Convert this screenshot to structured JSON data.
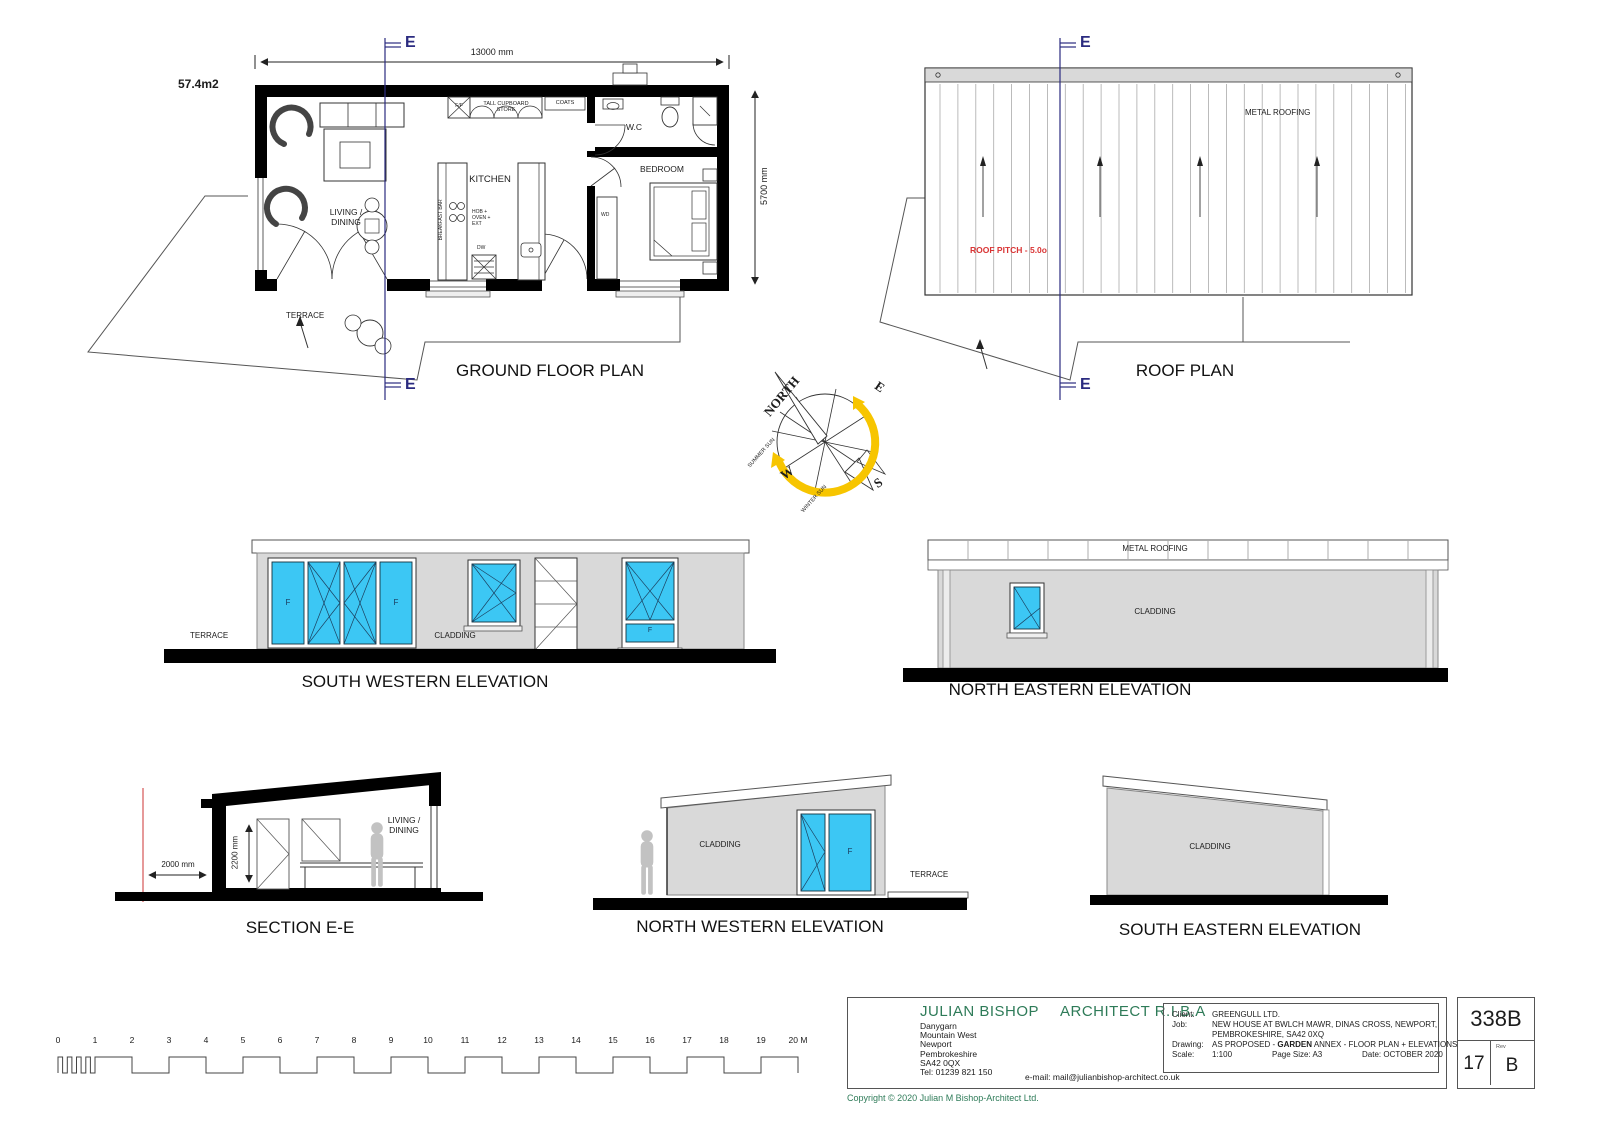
{
  "floor_plan": {
    "title": "GROUND FLOOR PLAN",
    "area": "57.4m2",
    "dim_width": "13000 mm",
    "dim_height": "5700 mm",
    "section_marker": "E",
    "living": "LIVING / DINING",
    "kitchen": "KITCHEN",
    "bedroom": "BEDROOM",
    "wc": "W.C",
    "terrace": "TERRACE",
    "coats": "COATS",
    "tall_cupboard": "TALL CUPBOARD STORE",
    "ff": "F/F",
    "breakfast_bar": "BREAKFAST BAR",
    "hob": "HOB + OVEN + EXT",
    "dw": "DW",
    "wd": "WD"
  },
  "roof_plan": {
    "title": "ROOF PLAN",
    "metal_roofing": "METAL ROOFING",
    "pitch": "ROOF PITCH - 5.0o",
    "section_marker": "E"
  },
  "compass": {
    "north": "NORTH",
    "east": "E",
    "west": "W",
    "south": "S",
    "summer_sun": "SUMMER SUN",
    "winter_sun": "WINTER SUN"
  },
  "elevation_sw": {
    "title": "SOUTH WESTERN ELEVATION",
    "terrace": "TERRACE",
    "cladding": "CLADDING",
    "f1": "F",
    "f2": "F",
    "f3": "F"
  },
  "elevation_ne": {
    "title": "NORTH EASTERN ELEVATION",
    "metal_roofing": "METAL ROOFING",
    "cladding": "CLADDING"
  },
  "section": {
    "title": "SECTION E-E",
    "room": "LIVING / DINING",
    "dim_offset": "2000 mm",
    "dim_height": "2200 mm"
  },
  "elevation_nw": {
    "title": "NORTH WESTERN ELEVATION",
    "cladding": "CLADDING",
    "terrace": "TERRACE",
    "f": "F"
  },
  "elevation_se": {
    "title": "SOUTH EASTERN ELEVATION",
    "cladding": "CLADDING"
  },
  "scale_bar": {
    "labels": [
      "0",
      "1",
      "2",
      "3",
      "4",
      "5",
      "6",
      "7",
      "8",
      "9",
      "10",
      "11",
      "12",
      "13",
      "14",
      "15",
      "16",
      "17",
      "18",
      "19",
      "20 M"
    ]
  },
  "title_block": {
    "architect_name": "JULIAN BISHOP",
    "architect_title": "ARCHITECT R.I.B.A",
    "address": [
      "Danygarn",
      "Mountain West",
      "Newport",
      "Pembrokeshire",
      "SA42 0QX",
      "Tel: 01239 821 150"
    ],
    "email": "e-mail: mail@julianbishop-architect.co.uk",
    "client_label": "Client:",
    "client": "GREENGULL LTD.",
    "job_label": "Job:",
    "job_line1": "NEW HOUSE AT BWLCH MAWR, DINAS CROSS, NEWPORT,",
    "job_line2": "PEMBROKESHIRE, SA42 0XQ",
    "drawing_label": "Drawing:",
    "drawing_pre": "AS PROPOSED - ",
    "drawing_bold": "GARDEN",
    "drawing_post": " ANNEX - FLOOR PLAN + ELEVATIONS",
    "scale_label": "Scale:",
    "scale_value": "1:100",
    "page_size": "Page Size: A3",
    "date": "Date: OCTOBER 2020",
    "number": "338B",
    "sheet": "17",
    "rev_label": "Rev",
    "rev": "B",
    "copyright": "Copyright © 2020 Julian M Bishop-Architect Ltd."
  },
  "colors": {
    "window_blue": "#3CC7F4",
    "wall_grey": "#D9D9D9",
    "marker_navy": "#2B2B80",
    "pitch_red": "#D93434",
    "brand_green": "#2E7B58",
    "sun_yellow": "#F7C500"
  }
}
